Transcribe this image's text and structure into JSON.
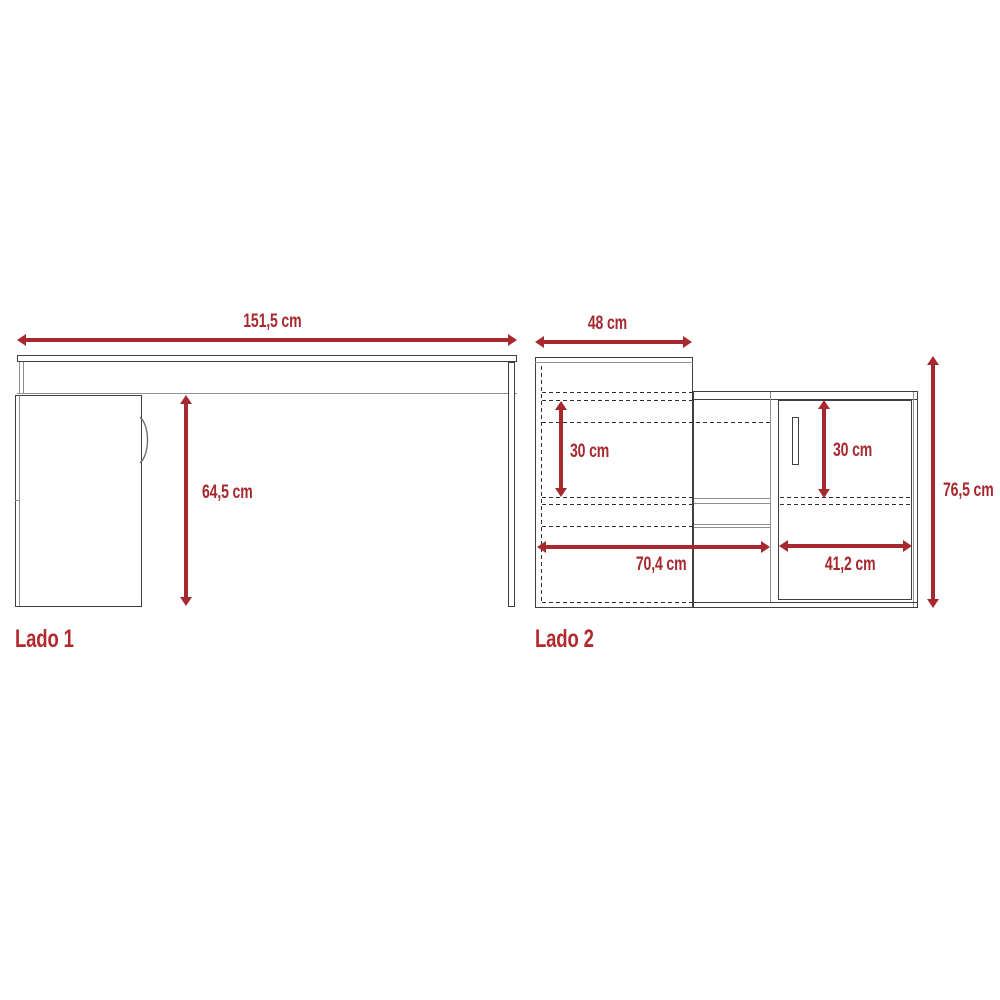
{
  "colors": {
    "dimension_red": "#A62930",
    "side_label_red": "#B4292E",
    "line_dark": "#3F3F3F",
    "line_gray": "#8F8F8F",
    "dash_color": "#2F2F2F",
    "background": "#FFFFFF"
  },
  "lado1": {
    "label": "Lado 1",
    "width_dim": "151,5 cm",
    "height_dim": "64,5 cm"
  },
  "lado2": {
    "label": "Lado 2",
    "depth_dim": "48 cm",
    "left_height_dim": "30 cm",
    "right_height_dim": "30 cm",
    "left_width_dim": "70,4 cm",
    "right_width_dim": "41,2 cm",
    "total_height_dim": "76,5 cm"
  }
}
